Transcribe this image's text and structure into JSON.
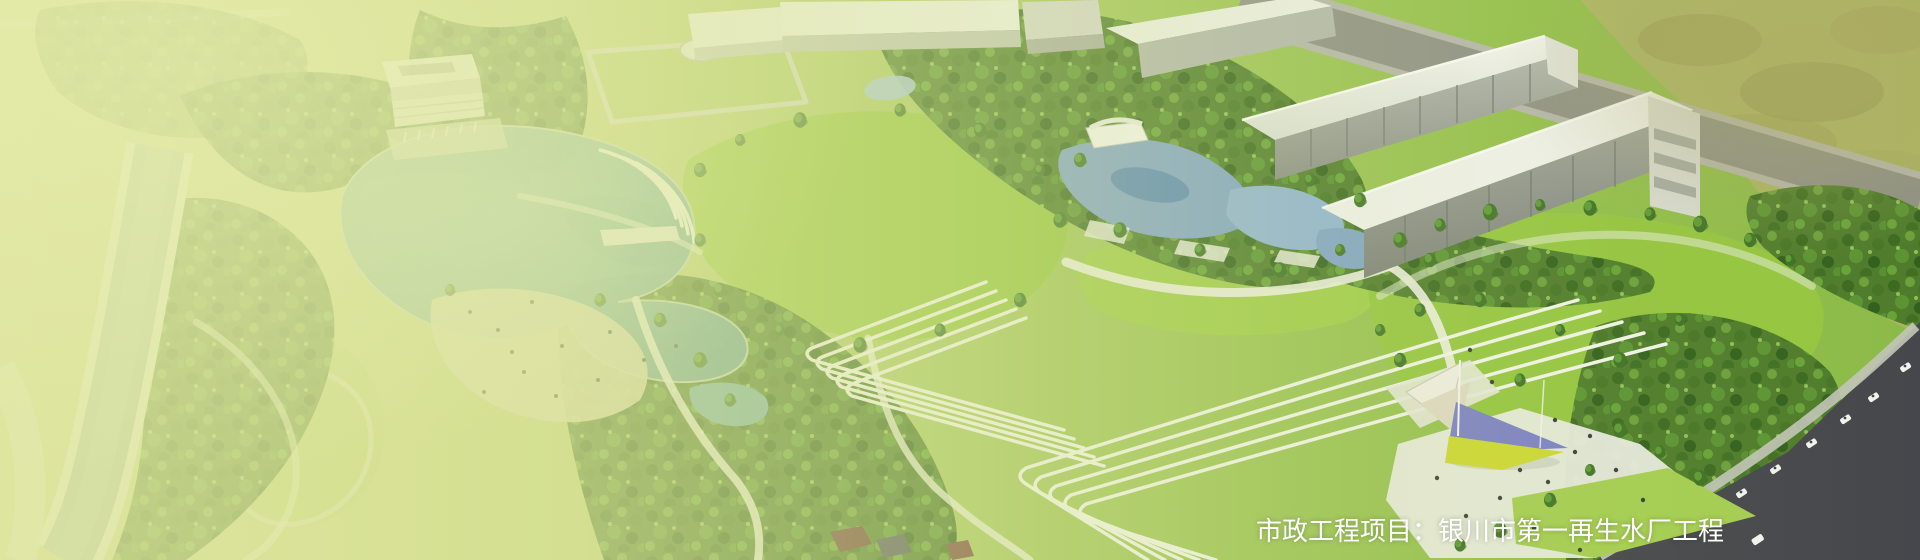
{
  "banner": {
    "caption": "市政工程项目：银川市第一再生水厂工程"
  },
  "palette": {
    "caption_color": "#ffffff",
    "wash_green": "#dde4a2",
    "lawn_green": "#98c743",
    "forest_green": "#4f7c2c",
    "lake_teal": "#74aca0",
    "pool_blue": "#7fa3c8",
    "building_white": "#eef0ea",
    "road_dark": "#46474c",
    "canopy_purple": "#7b80c5",
    "canopy_lime": "#ccd732"
  }
}
